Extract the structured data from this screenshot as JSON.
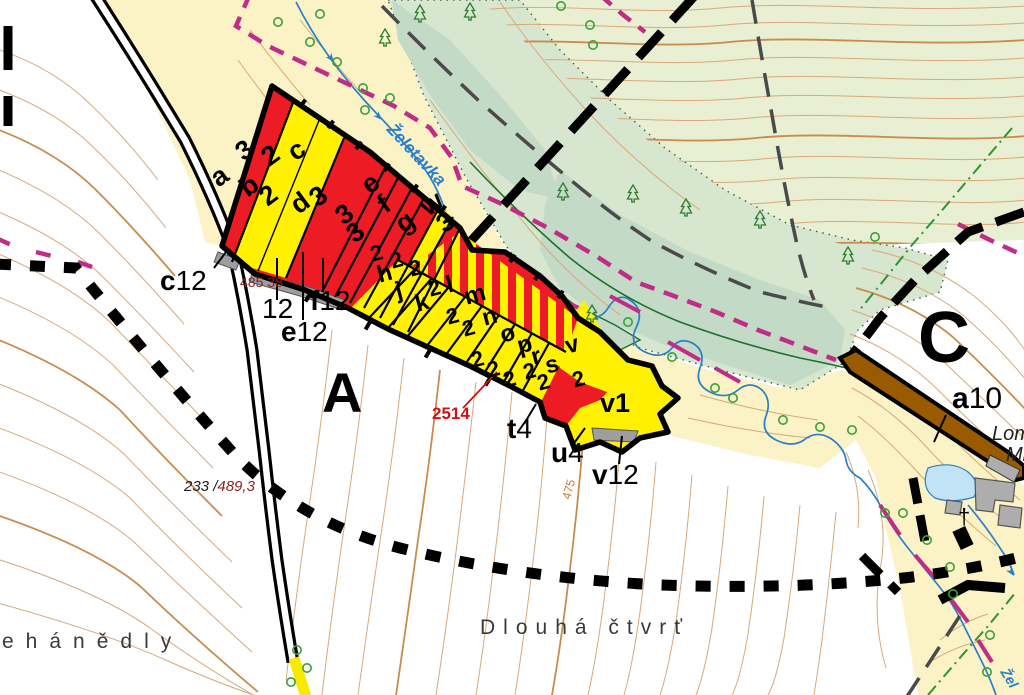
{
  "regions": {
    "A": "A",
    "C": "C"
  },
  "band": {
    "letters": {
      "a": "a",
      "b": "b",
      "c": "c",
      "d": "d",
      "e": "e",
      "f": "f",
      "g": "g",
      "w": "w",
      "h": "h",
      "j": "j",
      "k": "k",
      "l": "l",
      "m": "m",
      "n": "n",
      "o": "o",
      "p": "p",
      "r": "r",
      "s": "s",
      "v": "v"
    },
    "digit2": "2",
    "digit3": "3",
    "v1": "v1"
  },
  "refs": {
    "c12_l": "c",
    "c12_n": "12",
    "plain12": "12",
    "e12_l": "e",
    "e12_n": "12",
    "f12_l": "f",
    "f12_n": "12",
    "t4_l": "t",
    "t4_n": "4",
    "u4_l": "u",
    "u4_n": "4",
    "v12_l": "v",
    "v12_n": "12",
    "a10_l": "a",
    "a10_n": "10"
  },
  "annotations": {
    "p2514": "2514",
    "p485": "485 38",
    "spot_black": "233 /",
    "spot_red": "489,3",
    "c475": "475"
  },
  "places": {
    "left": "ehánědly",
    "center": "Dlouhá čtvrť",
    "lom": "Lom",
    "mr": "Mr"
  },
  "water": {
    "river": "Želetavka",
    "river2": "Žel"
  },
  "symbols": {
    "cross": "†"
  },
  "colors": {
    "parcel_red": "#ED1C24",
    "parcel_yellow": "#FFF100",
    "background_meadow": "#FBF3C6",
    "background_field": "#FFFFFF",
    "forest_light": "#E9EFD3",
    "forest_mid": "#D6E6CF",
    "forest_dark": "#C3DAC7",
    "contour_tan": "#D9A878",
    "stream_blue": "#2A7FC9",
    "pond_blue": "#C2E3F5",
    "boundary_black": "#000000",
    "boundary_magenta": "#C02C86",
    "boundary_gray": "#4A4A4A",
    "boundary_green": "#2E9430",
    "lane_brown": "#9A5B00",
    "building_gray": "#ADADAD",
    "label_maroon": "#8E1F1F",
    "label_red": "#D01217",
    "contour_label_orange": "#C77B3A"
  }
}
